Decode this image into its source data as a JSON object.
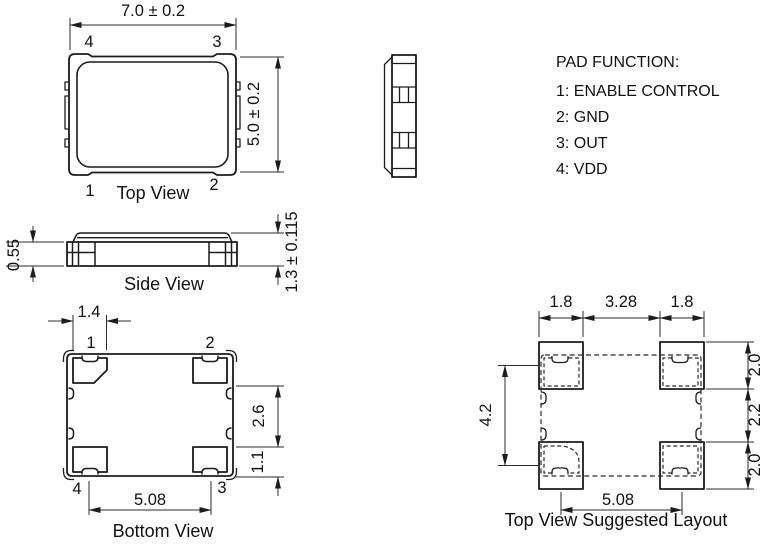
{
  "top_view": {
    "label": "Top View",
    "dim_width": "7.0 ± 0.2",
    "dim_height": "5.0 ± 0.2",
    "pin_top_left": "4",
    "pin_top_right": "3",
    "pin_bottom_left": "1",
    "pin_bottom_right": "2"
  },
  "side_view": {
    "label": "Side View",
    "dim_pad_thickness": "0.55",
    "dim_height": "1.3 ± 0.115"
  },
  "pad_function": {
    "title": "PAD FUNCTION:",
    "items": [
      "1: ENABLE CONTROL",
      "2: GND",
      "3: OUT",
      "4: VDD"
    ]
  },
  "bottom_view": {
    "label": "Bottom View",
    "dim_pad_width": "1.4",
    "dim_pad_gap": "2.6",
    "dim_pad_height": "1.1",
    "dim_pad_pitch": "5.08",
    "pin_top_left": "1",
    "pin_top_right": "2",
    "pin_bottom_left": "4",
    "pin_bottom_right": "3"
  },
  "suggested_layout": {
    "label": "Top View Suggested Layout",
    "dim_pad_width_left": "1.8",
    "dim_center_span": "3.28",
    "dim_pad_width_right": "1.8",
    "dim_pad_height_top": "2.0",
    "dim_row_gap": "2.2",
    "dim_pad_height_bottom": "2.0",
    "dim_vertical_pitch": "4.2",
    "dim_horizontal_pitch": "5.08"
  }
}
